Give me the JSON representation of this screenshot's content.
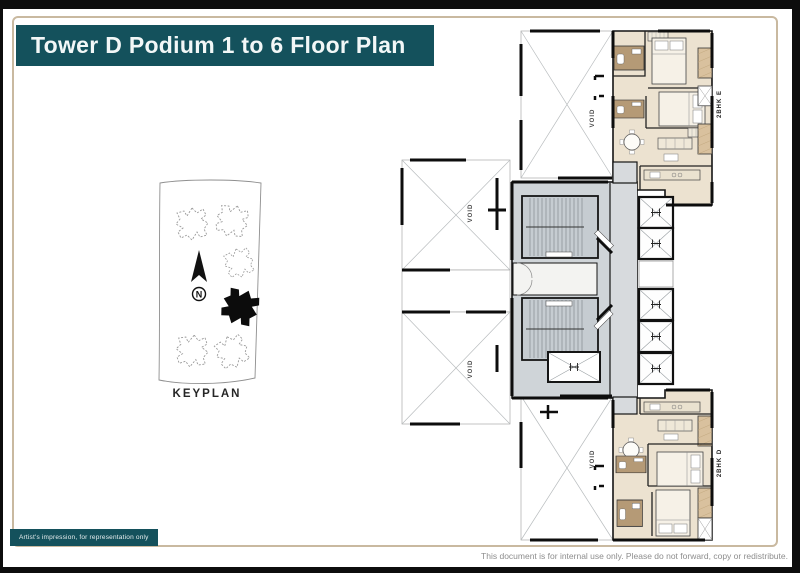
{
  "title": "Tower D Podium 1 to 6 Floor Plan",
  "keyplan": {
    "caption": "KEYPLAN",
    "north": "N"
  },
  "plan": {
    "void_label": "VOID",
    "unit_e": "2BHK E",
    "unit_d": "2BHK D"
  },
  "footer": {
    "artist_note": "Artist's impression, for representation only",
    "disclaimer": "This document is for internal use only. Please do not forward, copy or redistribute."
  },
  "colors": {
    "accent_teal": "#14515c",
    "frame_tan": "#c9b9a0",
    "floor_beige": "#ece2d0",
    "balcony_tan": "#d9c19e",
    "tile_brown": "#b59a76",
    "core_gray": "#cfd4d8",
    "wall_black": "#111111"
  }
}
